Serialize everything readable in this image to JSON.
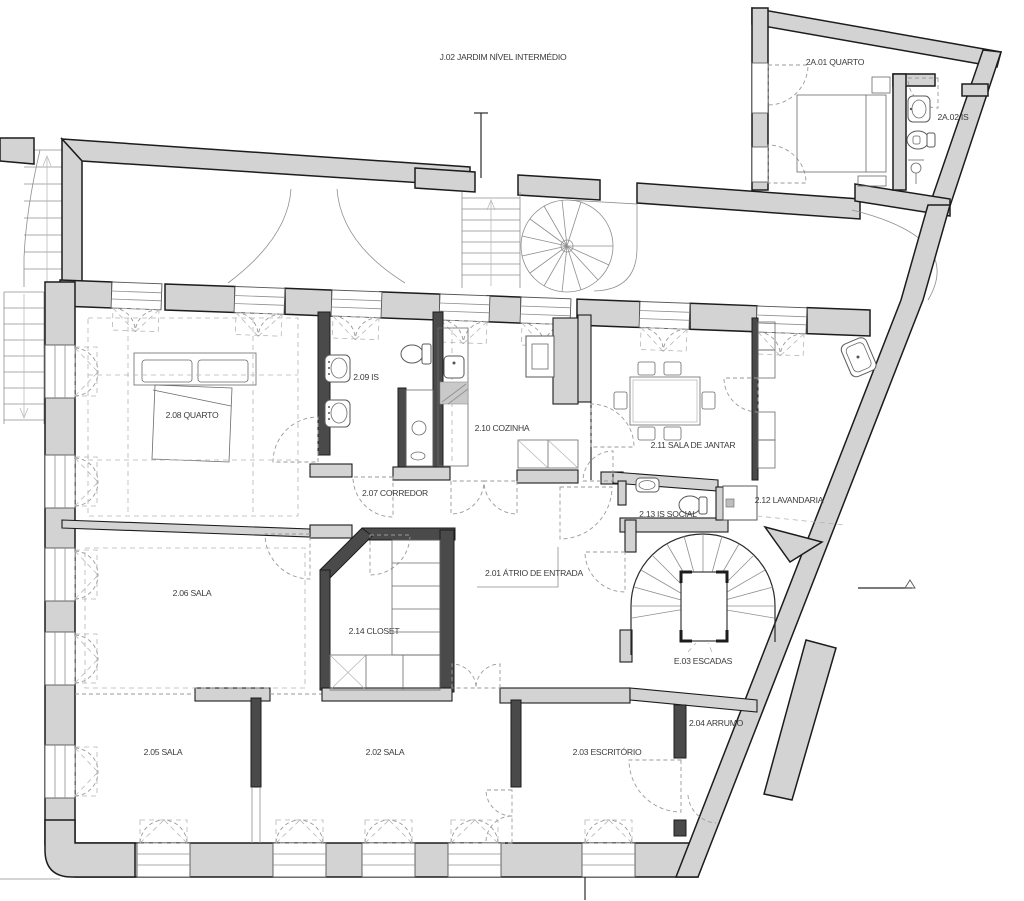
{
  "drawing": {
    "type": "architectural-floor-plan",
    "labels": {
      "garden": "J.02 JARDIM NÍVEL INTERMÉDIO",
      "annex_bedroom": "2A.01 QUARTO",
      "annex_bath": "2A.02 IS",
      "atrium": "2.01 ÁTRIO DE ENTRADA",
      "sala2": "2.02 SALA",
      "office": "2.03 ESCRITÓRIO",
      "storage": "2.04 ARRUMO",
      "sala5": "2.05 SALA",
      "sala6": "2.06 SALA",
      "corridor": "2.07 CORREDOR",
      "bedroom": "2.08 QUARTO",
      "bath": "2.09 IS",
      "kitchen": "2.10 COZINHA",
      "dining": "2.11 SALA DE JANTAR",
      "laundry": "2.12 LAVANDARIA",
      "wc": "2.13 IS SOCIAL",
      "closet": "2.14 CLOSET",
      "stairs": "E.03 ESCADAS"
    },
    "colors": {
      "wall_fill": "#d3d3d3",
      "partition_fill": "#4a4a4a",
      "outline": "#1c1c1c",
      "thin_line": "#8f8f8f",
      "dashed_line": "#9a9a9a",
      "text": "#3c3c3c",
      "background": "#ffffff"
    },
    "icons": [
      "double-bed-icon",
      "single-bed-icon",
      "washbasin-icon",
      "toilet-icon",
      "shower-icon",
      "bathtub-icon",
      "washing-machine-icon",
      "dining-table-icon",
      "chair-icon",
      "kitchen-counter-icon",
      "stove-icon",
      "spiral-stair-icon",
      "stair-flight-icon",
      "wardrobe-shelf-icon",
      "window-shutter-icon",
      "door-swing-icon",
      "datum-marker-icon"
    ]
  }
}
